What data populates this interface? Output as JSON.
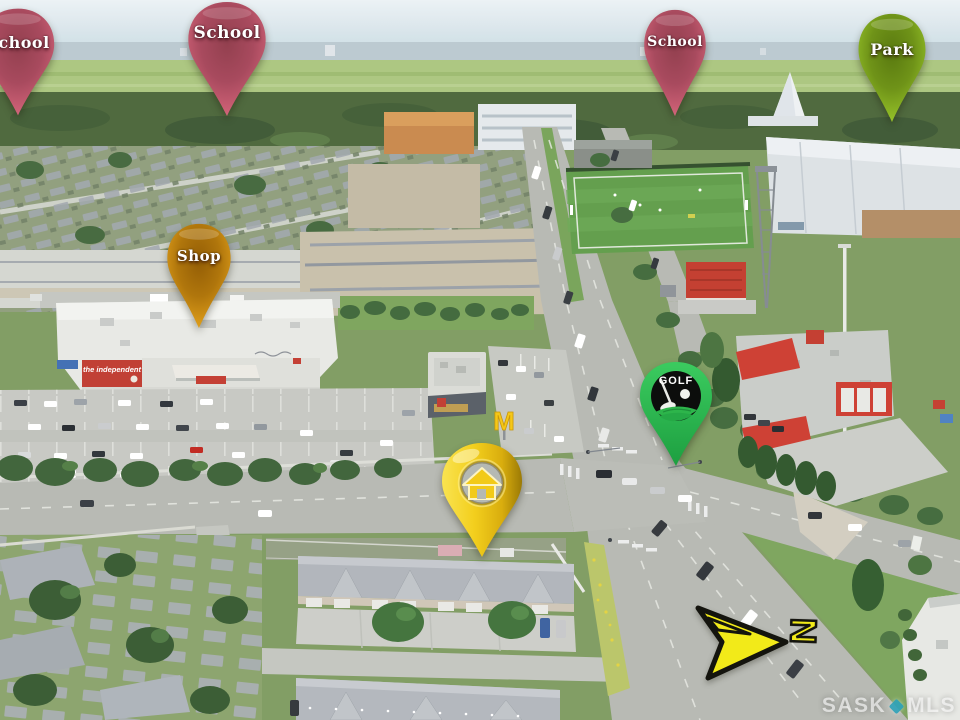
{
  "pins": [
    {
      "id": "school-upper-left",
      "label": "School",
      "color": "#db7489"
    },
    {
      "id": "school-upper-middle",
      "label": "School",
      "color": "#db7489"
    },
    {
      "id": "school-upper-right",
      "label": "School",
      "color": "#db7489"
    },
    {
      "id": "park",
      "label": "Park",
      "color": "#a2cd33"
    },
    {
      "id": "shop",
      "label": "Shop",
      "color": "#e8ab24"
    },
    {
      "id": "golf",
      "label": "GOLF",
      "color": "#2db54b"
    },
    {
      "id": "home",
      "label": "",
      "color": "#f2cd17"
    }
  ],
  "compass": {
    "letter": "N",
    "arrow_color": "#f2ea19",
    "points": "right"
  },
  "watermark": {
    "left": "SASK",
    "right": "MLS",
    "dot_color": "#2fa3ba"
  },
  "photo": {
    "grocery_sign": "the independent",
    "mcdonalds_logo": "M"
  }
}
